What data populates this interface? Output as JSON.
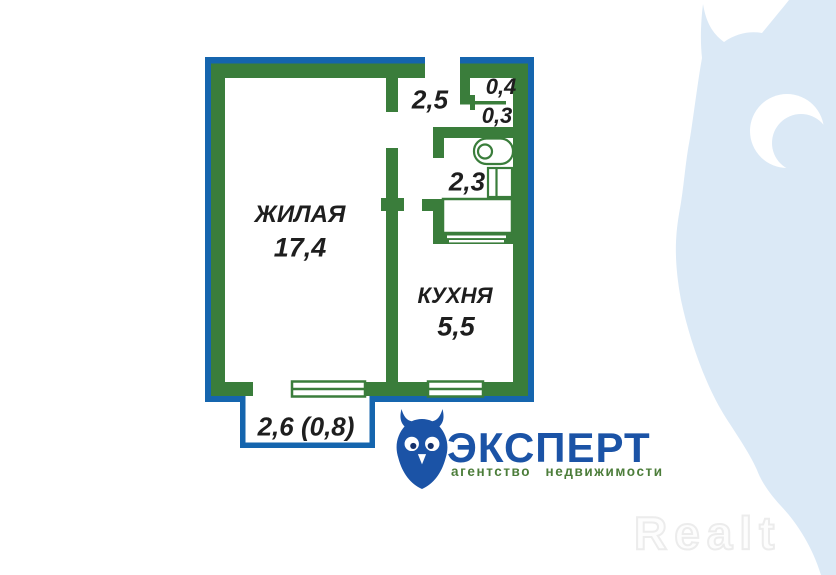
{
  "floor_plan": {
    "rooms": {
      "living": {
        "name": "ЖИЛАЯ",
        "area": "17,4"
      },
      "kitchen": {
        "name": "КУХНЯ",
        "area": "5,5"
      },
      "bathroom": {
        "area": "2,3"
      },
      "hallway": {
        "area": "2,5"
      },
      "closet_top": {
        "area": "0,4"
      },
      "closet_bottom": {
        "area": "0,3"
      },
      "balcony": {
        "area": "2,6 (0,8)"
      }
    },
    "colors": {
      "wall_green": "#3a7d3b",
      "outline_blue": "#1565ae",
      "label_text": "#1e1e1e"
    },
    "icons": [
      "toilet-icon",
      "sink-icon",
      "bathtub-icon",
      "window-icon"
    ]
  },
  "logo": {
    "brand": "ЭКСПЕРТ",
    "tagline": "агентство недвижимости",
    "brand_color": "#1b53a6",
    "tagline_color": "#4c7d3a",
    "icon": "owl-icon"
  },
  "watermarks": {
    "realt_text": "Realt",
    "owl_color": "#dbe9f6"
  }
}
